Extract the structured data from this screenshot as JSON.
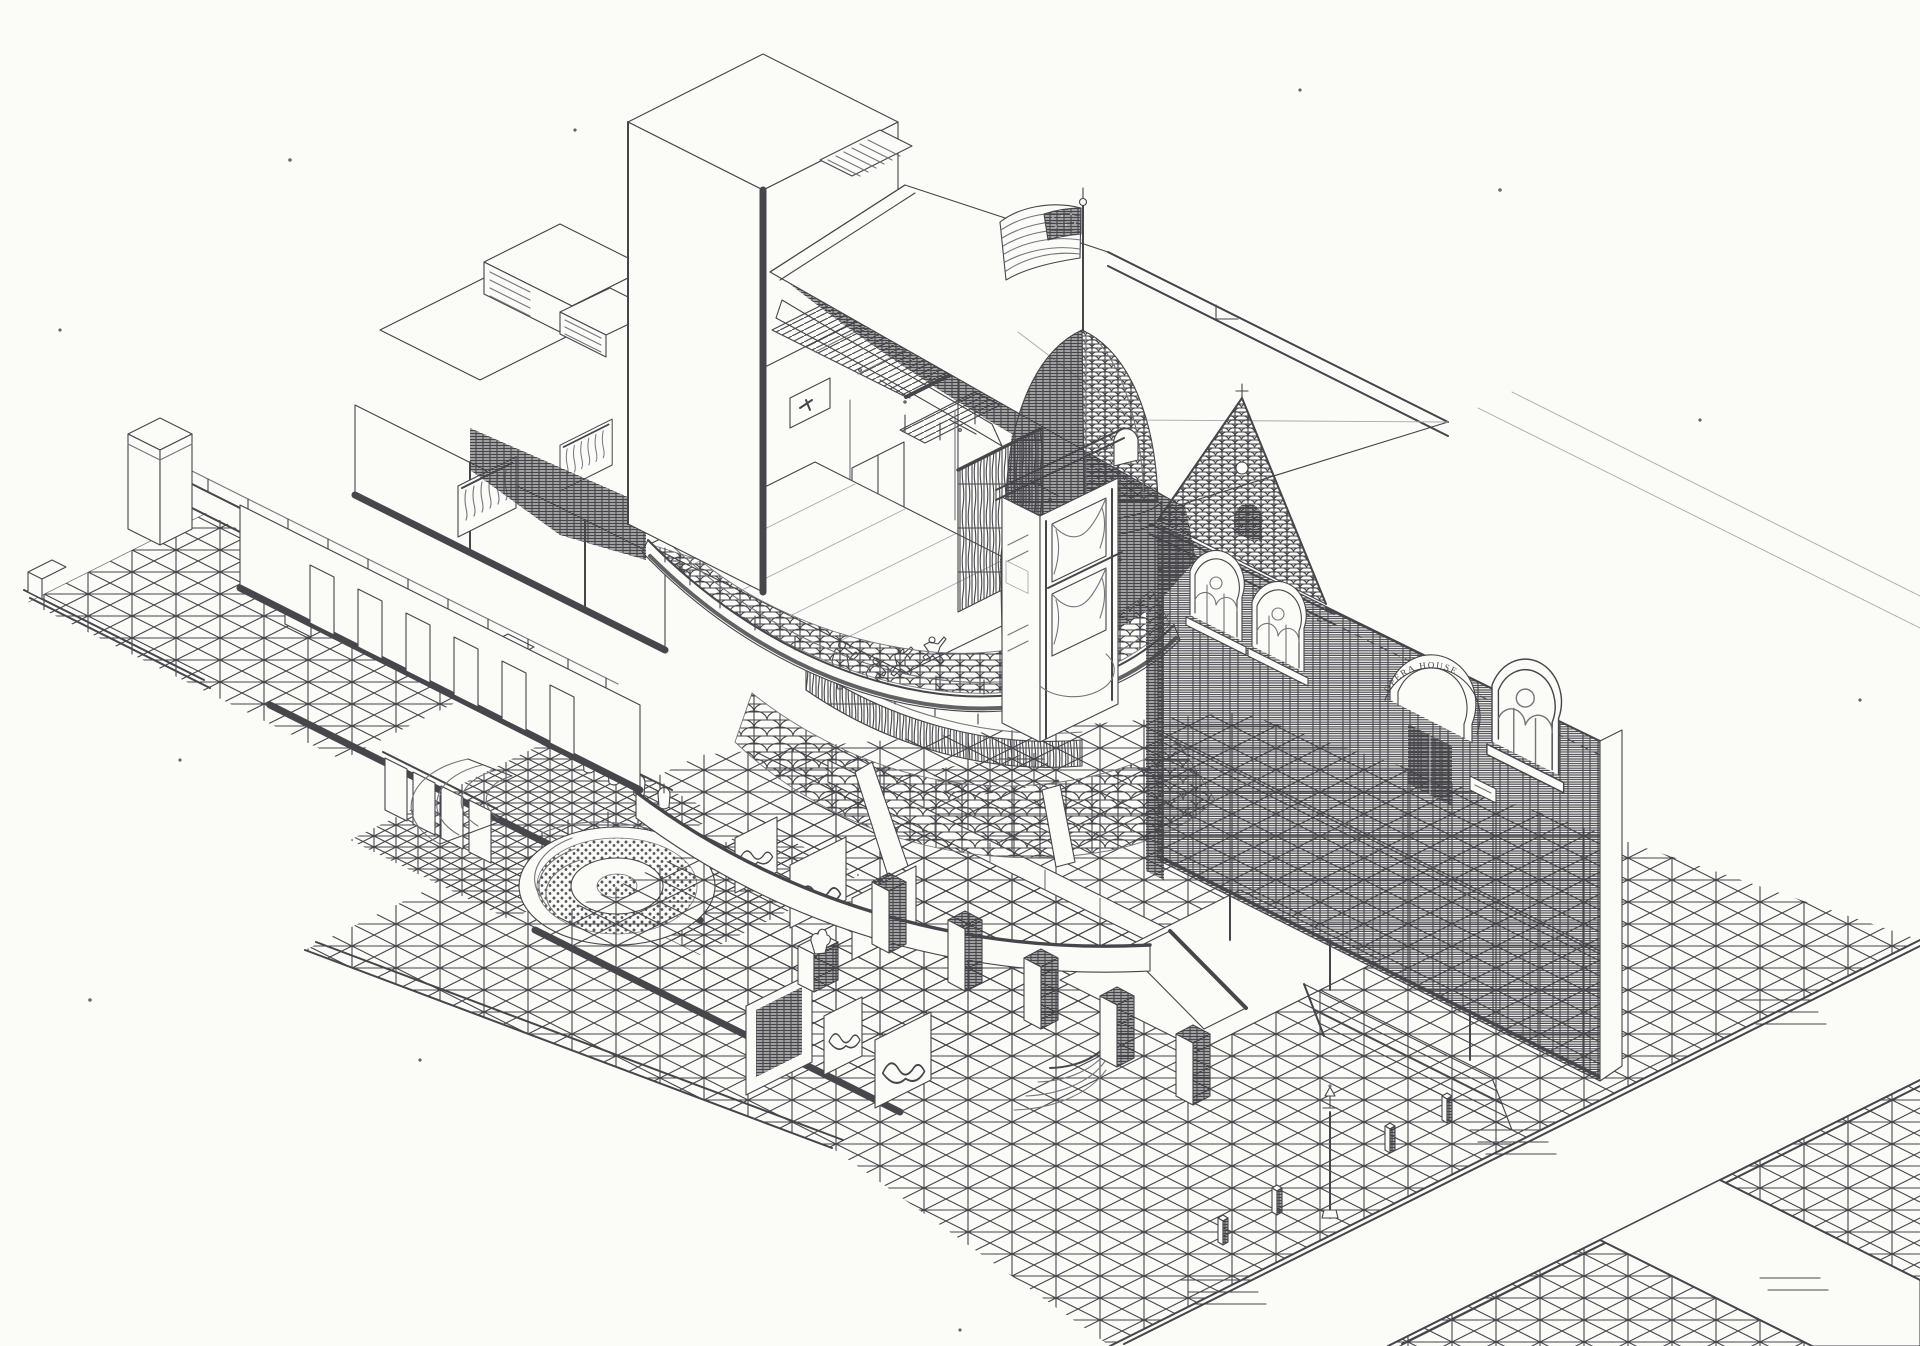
{
  "meta": {
    "description": "Hand-drawn isometric cutaway pen-and-ink architectural drawing of a Victorian corner opera house: fly tower and rigging grid, stage with four performers, curved orchestra and balcony seating, stacked proscenium boxes, sectioned dome with American flag, ornate brick facade, backstage dressing rooms, basement lounge with circular sunken seating, and surrounding sidewalks and streets."
  },
  "theme": {
    "paper": "#fbfbf8",
    "ink": "#45454a",
    "ink-soft": "#74747b",
    "ink-faint": "#a9a9af",
    "poche": "#46464b"
  },
  "facade": {
    "arch_inscription": "OPERA HOUSE"
  },
  "inventory": {
    "ground": "Sidewalks with scored paving grid, curbs, streets with lane markings",
    "basement": "Basement level: washroom stalls, urinals, circular sunken lounge with stepped carpet ring",
    "lobby": "Entrance lobby with tiled floor, mural panels, statue and portal",
    "left_wing": "Backstage wing: dressing rooms, costume racks, rooftop vents and duct",
    "auditorium": "Auditorium: stage, orchestra pit, curved seating, balcony and gallery",
    "stage": "Stage floor with four dancing performers",
    "ceiling": "Sectioned auditorium ceiling shown as dark cutaway poche",
    "fly_tower": "Stage fly tower with gridiron, catwalk and skylight",
    "roof": "Auditorium hip roof with parapet",
    "dome": "Corner dome turret cut in section with fish-scale shingles",
    "flag": "American flag on the dome flagpole",
    "boxes": "Stacked proscenium boxes with curtains",
    "facade_block": "Victorian brick street facade with arched windows and entry arch",
    "furniture": "Entry piers, bollards and street lamp"
  }
}
